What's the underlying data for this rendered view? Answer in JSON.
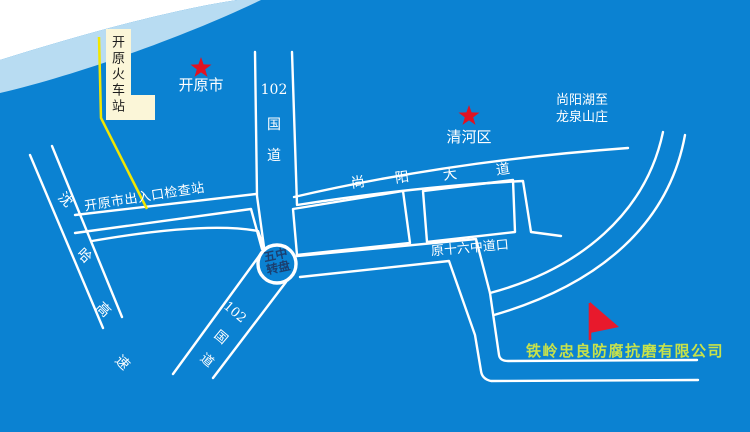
{
  "map": {
    "title": "开原地图示意图",
    "colors": {
      "background": "#0b82d2",
      "river": "#b8dcf2",
      "corner": "#ffffff",
      "road": "#ffffff",
      "station_box": "#fbf6d8",
      "station_route_line": "#f2e600",
      "star": "#e01222",
      "flag": "#e8192c",
      "roundabout_text": "#1b3f70",
      "company_text": "#c8e24a"
    },
    "landmarks": {
      "train_station": {
        "label": "开原火车站"
      },
      "kaiyuan_city": {
        "label": "开原市"
      },
      "qinghe_district": {
        "label": "清河区"
      },
      "lake_route": {
        "line1": "尚阳湖至",
        "line2": "龙泉山庄"
      },
      "roundabout": {
        "line1": "五中",
        "line2": "转盘"
      },
      "company": {
        "label": "铁岭忠良防腐抗磨有限公司"
      }
    },
    "roads": {
      "g102_north": {
        "num": "102",
        "char1": "国",
        "char2": "道"
      },
      "g102_south": {
        "num": "102",
        "char1": "国",
        "char2": "道"
      },
      "shenha_expressway": {
        "chars": [
          "沈",
          "哈",
          "高",
          "速"
        ]
      },
      "shangyang_avenue": {
        "chars": [
          "尚",
          "阳",
          "大",
          "道"
        ]
      },
      "checkpoint_road": {
        "label": "开原市出入口检查站"
      },
      "no16_crossing": {
        "label": "原十六中道口"
      }
    }
  }
}
